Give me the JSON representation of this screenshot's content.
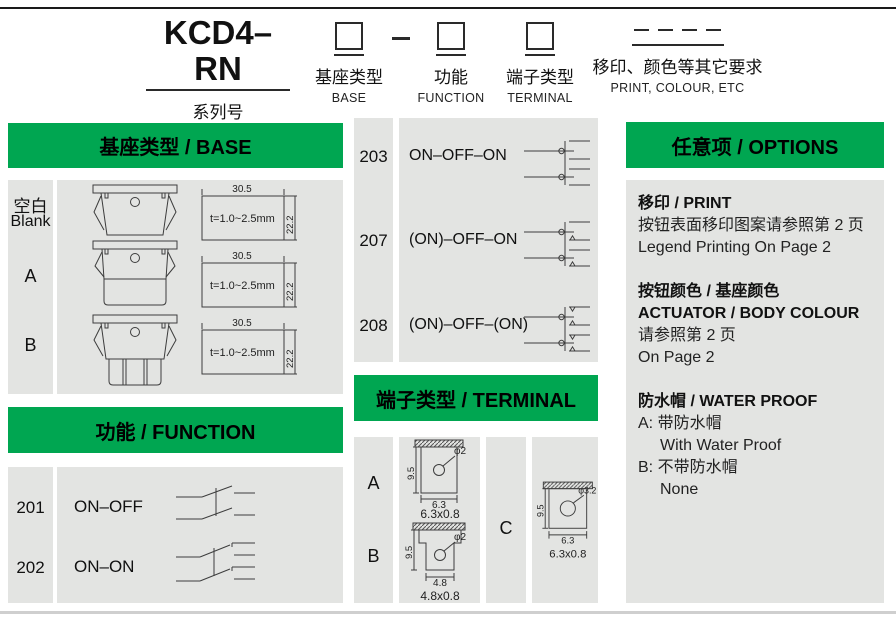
{
  "colors": {
    "accent_green": "#00a651",
    "panel_gray": "#e3e4e2"
  },
  "code_builder": {
    "series_code": "KCD4–RN",
    "fields": [
      {
        "label_cn": "系列号",
        "label_en": "SERIES"
      },
      {
        "label_cn": "基座类型",
        "label_en": "BASE"
      },
      {
        "label_cn": "功能",
        "label_en": "FUNCTION"
      },
      {
        "label_cn": "端子类型",
        "label_en": "TERMINAL"
      },
      {
        "label_cn": "移印、颜色等其它要求",
        "label_en": "PRINT, COLOUR, ETC"
      }
    ]
  },
  "base_section": {
    "title": "基座类型 / BASE",
    "rows": [
      {
        "label_cn": "空白",
        "label_en": "Blank"
      },
      {
        "label": "A"
      },
      {
        "label": "B"
      }
    ],
    "cutout": {
      "width": "30.5",
      "height": "22.2",
      "thickness": "t=1.0~2.5mm"
    }
  },
  "function_section": {
    "title": "功能 / FUNCTION",
    "rows": [
      {
        "code": "201",
        "label": "ON–OFF"
      },
      {
        "code": "202",
        "label": "ON–ON"
      },
      {
        "code": "203",
        "label": "ON–OFF–ON"
      },
      {
        "code": "207",
        "label": "(ON)–OFF–ON"
      },
      {
        "code": "208",
        "label": "(ON)–OFF–(ON)"
      }
    ]
  },
  "terminal_section": {
    "title": "端子类型 / TERMINAL",
    "items": [
      {
        "label": "A",
        "height": "9.5",
        "hole": "φ2",
        "width": "6.3",
        "caption": "6.3x0.8"
      },
      {
        "label": "B",
        "height": "9.5",
        "hole": "φ2",
        "width": "4.8",
        "caption": "4.8x0.8"
      },
      {
        "label": "C",
        "height": "9.5",
        "hole": "φ3.2",
        "width": "6.3",
        "caption": "6.3x0.8"
      }
    ]
  },
  "options_section": {
    "title": "任意项 / OPTIONS",
    "print": {
      "title": "移印 / PRINT",
      "line_cn": "按钮表面移印图案请参照第 2 页",
      "line_en": "Legend Printing On Page 2"
    },
    "colour": {
      "title_cn": "按钮颜色 / 基座颜色",
      "title_en": "ACTUATOR / BODY COLOUR",
      "line_cn": "请参照第 2 页",
      "line_en": "On Page 2"
    },
    "waterproof": {
      "title": "防水帽 / WATER PROOF",
      "option_a": "A: 带防水帽",
      "option_a_en": "With Water Proof",
      "option_b": "B: 不带防水帽",
      "option_b_en": "None"
    }
  }
}
